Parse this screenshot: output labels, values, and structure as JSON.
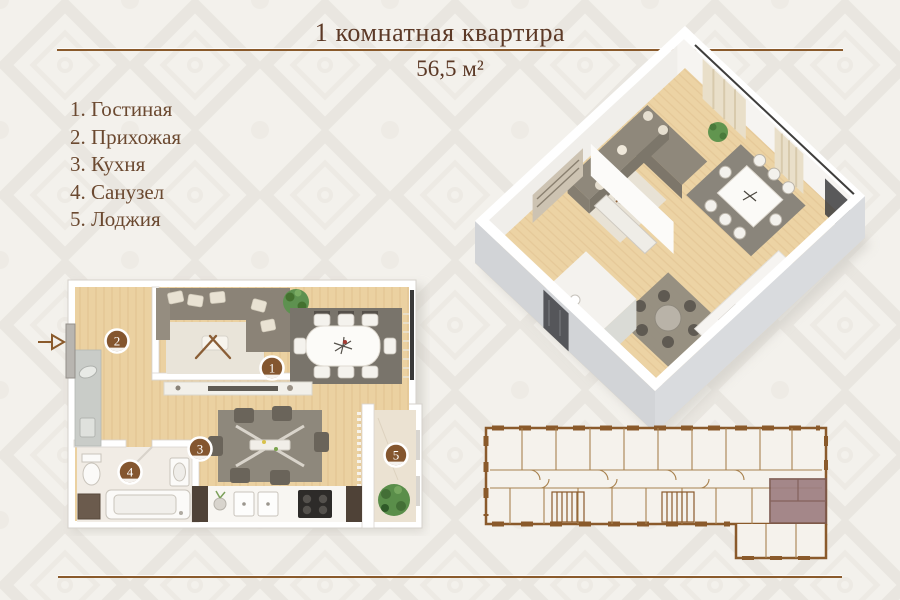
{
  "header": {
    "title": "1 комнатная квартира",
    "area": "56,5 м²"
  },
  "legend": {
    "items": [
      "1. Гостиная",
      "2. Прихожая",
      "3. Кухня",
      "4. Санузел",
      "5. Лоджия"
    ]
  },
  "plan2d": {
    "badges": [
      "1",
      "2",
      "3",
      "4",
      "5"
    ]
  },
  "colors": {
    "accent_brown": "#8a5a2b",
    "title_text": "#5c3926",
    "legend_text": "#6b4930",
    "badge_brown": "#84562f",
    "schematic_line": "#a8824f",
    "highlight_unit": "#9c7c7f",
    "wood_floor": "#ebd1a1",
    "wall_white": "#ffffff"
  }
}
